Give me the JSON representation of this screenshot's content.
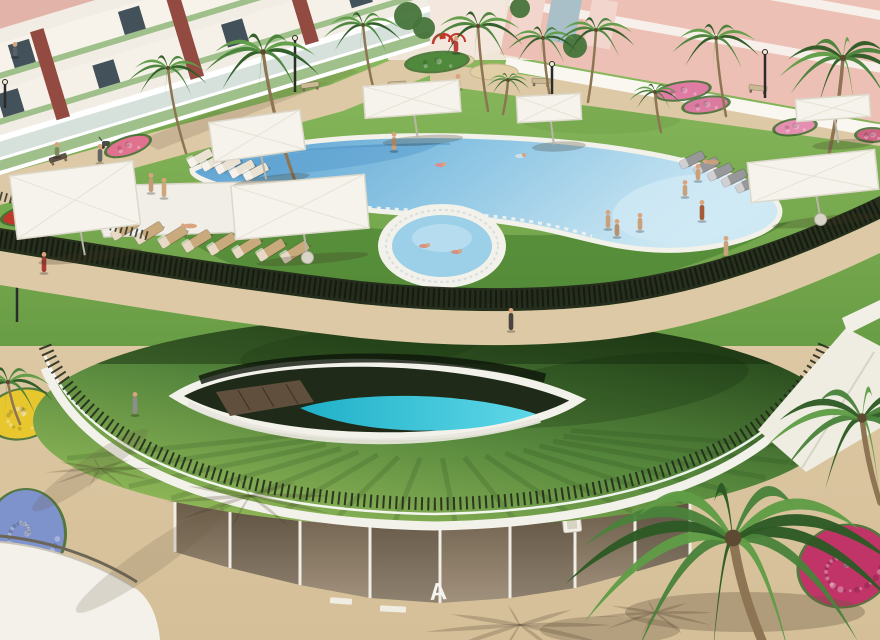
{
  "meta": {
    "title": "Aerial 3D render of residential resort pool courtyard",
    "type": "3d-architectural-render",
    "description": "Apartment complex garden with curved lagoon pool, circular kids pool, sun loungers, white parasols, palm trees and a grass-roofed clubhouse containing a lower-level lap pool"
  },
  "signage": {
    "block_letter": "A"
  },
  "palette": {
    "sand": "#ddc9a6",
    "sand_shadow": "#b59a74",
    "lawn_light": "#8cbb5e",
    "lawn_dark": "#699d45",
    "terrace_band": "#3f7a2c",
    "roof_dark": "#1f3d16",
    "roof_mid": "#55863c",
    "roof_light": "#9cc25e",
    "fence": "#22271b",
    "rim": "#f2f1ea",
    "pool_deep": "#5a9fd0",
    "pool_mid": "#8ec6e4",
    "pool_light": "#cfe9f4",
    "lap_pool": "#2ec4d9",
    "deck_wood": "#5f4f3c",
    "facade_dark": "#6f604c",
    "facade_light": "#a79782",
    "mullion": "#f0ede4",
    "building_white": "#f2ede4",
    "building_pink": "#ecc0b4",
    "building_pink_light": "#f2d5cc",
    "building_accent": "#934a40",
    "window": "#42515a",
    "trunk": "#8d7553",
    "palm_1": "#2d5a24",
    "palm_2": "#49823a",
    "palm_3": "#5f9c46",
    "umbrella": "#f5f3ec",
    "skin": "#d9a57e",
    "flame": "#ff8a28",
    "white_wall": "#f3f1ea"
  },
  "people_standing": [
    {
      "x": 100,
      "y": 162,
      "c": "#636660",
      "h": 13
    },
    {
      "x": 57,
      "y": 156,
      "c": "#7c8a5c",
      "h": 9
    },
    {
      "x": 151,
      "y": 192,
      "c": "#c59a76",
      "h": 14
    },
    {
      "x": 164,
      "y": 197,
      "c": "#cfa57e",
      "h": 14
    },
    {
      "x": 44,
      "y": 272,
      "c": "#a83a32",
      "h": 15
    },
    {
      "x": 135,
      "y": 414,
      "c": "#8d8d8b",
      "h": 17
    },
    {
      "x": 511,
      "y": 330,
      "c": "#4a4440",
      "h": 17
    },
    {
      "x": 456,
      "y": 52,
      "c": "#b84038",
      "h": 11
    },
    {
      "x": 458,
      "y": 88,
      "c": "#c59a76",
      "h": 9
    },
    {
      "x": 394,
      "y": 150,
      "c": "#c8a07c",
      "h": 13
    },
    {
      "x": 15,
      "y": 56,
      "c": "#5a5f66",
      "h": 9
    },
    {
      "x": 608,
      "y": 228,
      "c": "#c8a07c",
      "h": 13
    },
    {
      "x": 617,
      "y": 236,
      "c": "#b8906c",
      "h": 12
    },
    {
      "x": 640,
      "y": 230,
      "c": "#c8a07c",
      "h": 12
    },
    {
      "x": 698,
      "y": 180,
      "c": "#c8a07c",
      "h": 11
    },
    {
      "x": 685,
      "y": 196,
      "c": "#c8a07c",
      "h": 11
    },
    {
      "x": 702,
      "y": 220,
      "c": "#a55a38",
      "h": 15
    },
    {
      "x": 726,
      "y": 256,
      "c": "#c8a07c",
      "h": 15
    }
  ],
  "people_swimming": [
    {
      "x": 440,
      "y": 165,
      "c": "#e08a8a"
    },
    {
      "x": 338,
      "y": 181,
      "c": "#d9a57e"
    },
    {
      "x": 520,
      "y": 156,
      "c": "#cfe2ee"
    },
    {
      "x": 424,
      "y": 246,
      "c": "#d98c78"
    },
    {
      "x": 456,
      "y": 252,
      "c": "#d98c78"
    }
  ],
  "people_lying": [
    {
      "x": 712,
      "y": 162,
      "c": "#c8a07c"
    },
    {
      "x": 190,
      "y": 226,
      "c": "#d9a57e"
    }
  ],
  "palms_back": [
    {
      "x": 263,
      "y": 52,
      "r": 58,
      "dx": 40,
      "th": 150
    },
    {
      "x": 168,
      "y": 68,
      "r": 40,
      "dx": 18,
      "th": 85
    },
    {
      "x": 363,
      "y": 25,
      "r": 40,
      "dx": 12,
      "th": 70
    },
    {
      "x": 478,
      "y": 26,
      "r": 46,
      "dx": 10,
      "th": 85
    },
    {
      "x": 543,
      "y": 38,
      "r": 36,
      "dx": 8,
      "th": 66
    },
    {
      "x": 596,
      "y": 30,
      "r": 40,
      "dx": -8,
      "th": 72
    },
    {
      "x": 716,
      "y": 38,
      "r": 44,
      "dx": 10,
      "th": 78
    },
    {
      "x": 843,
      "y": 58,
      "r": 64,
      "dx": -16,
      "th": 105
    },
    {
      "x": 655,
      "y": 92,
      "r": 26,
      "dx": 6,
      "th": 40
    },
    {
      "x": 508,
      "y": 80,
      "r": 22,
      "dx": -5,
      "th": 34
    }
  ],
  "palms_front": [
    {
      "x": 8,
      "y": 382,
      "r": 46,
      "dx": 12,
      "th": 42
    },
    {
      "x": 862,
      "y": 418,
      "r": 96,
      "dx": 18,
      "th": 85
    },
    {
      "x": 733,
      "y": 538,
      "r": 168,
      "dx": 30,
      "th": 105
    }
  ],
  "shadow_fronds": [
    {
      "x": 250,
      "y": 495,
      "r": 85
    },
    {
      "x": 520,
      "y": 624,
      "r": 95
    },
    {
      "x": 655,
      "y": 612,
      "r": 60
    },
    {
      "x": 100,
      "y": 468,
      "r": 55
    }
  ],
  "umbrellas": [
    {
      "x": 257,
      "y": 136,
      "w": 92,
      "h": 40,
      "rot": -8,
      "base": false
    },
    {
      "x": 75,
      "y": 200,
      "w": 124,
      "h": 64,
      "rot": -7,
      "base": false
    },
    {
      "x": 300,
      "y": 207,
      "w": 134,
      "h": 54,
      "rot": -5,
      "base": true
    },
    {
      "x": 412,
      "y": 99,
      "w": 96,
      "h": 32,
      "rot": -4,
      "base": false
    },
    {
      "x": 549,
      "y": 108,
      "w": 64,
      "h": 26,
      "rot": -3,
      "base": false
    },
    {
      "x": 833,
      "y": 108,
      "w": 74,
      "h": 22,
      "rot": -4,
      "base": false
    },
    {
      "x": 813,
      "y": 176,
      "w": 128,
      "h": 40,
      "rot": -6,
      "base": true
    }
  ],
  "loungers": [
    {
      "x": 200,
      "y": 158,
      "rot": -28,
      "c": "#eae2d2",
      "w": 26,
      "h": 9
    },
    {
      "x": 214,
      "y": 162,
      "rot": -28,
      "c": "#eae2d2",
      "w": 26,
      "h": 9
    },
    {
      "x": 228,
      "y": 165,
      "rot": -28,
      "c": "#eae2d2",
      "w": 26,
      "h": 9
    },
    {
      "x": 242,
      "y": 169,
      "rot": -28,
      "c": "#eae2d2",
      "w": 26,
      "h": 9
    },
    {
      "x": 256,
      "y": 172,
      "rot": -28,
      "c": "#eae2d2",
      "w": 26,
      "h": 9
    },
    {
      "x": 125,
      "y": 229,
      "rot": -32,
      "c": "#c9aa7c",
      "w": 30,
      "h": 10
    },
    {
      "x": 149,
      "y": 233,
      "rot": -32,
      "c": "#c9aa7c",
      "w": 30,
      "h": 10
    },
    {
      "x": 173,
      "y": 237,
      "rot": -32,
      "c": "#c9aa7c",
      "w": 30,
      "h": 10
    },
    {
      "x": 197,
      "y": 241,
      "rot": -32,
      "c": "#c9aa7c",
      "w": 30,
      "h": 10
    },
    {
      "x": 222,
      "y": 244,
      "rot": -32,
      "c": "#c9aa7c",
      "w": 30,
      "h": 10
    },
    {
      "x": 247,
      "y": 247,
      "rot": -32,
      "c": "#c9aa7c",
      "w": 30,
      "h": 10
    },
    {
      "x": 271,
      "y": 250,
      "rot": -32,
      "c": "#c9aa7c",
      "w": 30,
      "h": 10
    },
    {
      "x": 295,
      "y": 252,
      "rot": -32,
      "c": "#c9aa7c",
      "w": 30,
      "h": 10
    },
    {
      "x": 692,
      "y": 160,
      "rot": -26,
      "c": "#98989a",
      "w": 26,
      "h": 9
    },
    {
      "x": 706,
      "y": 166,
      "rot": -26,
      "c": "#98989a",
      "w": 26,
      "h": 9
    },
    {
      "x": 720,
      "y": 172,
      "rot": -26,
      "c": "#98989a",
      "w": 26,
      "h": 9
    },
    {
      "x": 734,
      "y": 178,
      "rot": -26,
      "c": "#98989a",
      "w": 26,
      "h": 9
    },
    {
      "x": 748,
      "y": 184,
      "rot": -26,
      "c": "#98989a",
      "w": 26,
      "h": 9
    }
  ],
  "flower_beds": [
    {
      "x": 58,
      "y": 210,
      "rx": 56,
      "ry": 12,
      "c": "#bb3a2c",
      "rot": -10
    },
    {
      "x": 128,
      "y": 146,
      "rx": 22,
      "ry": 8,
      "c": "#e0718f",
      "rot": -18
    },
    {
      "x": 683,
      "y": 91,
      "rx": 26,
      "ry": 8,
      "c": "#e07ba3",
      "rot": -8
    },
    {
      "x": 706,
      "y": 105,
      "rx": 22,
      "ry": 7,
      "c": "#db7ba0",
      "rot": -8
    },
    {
      "x": 795,
      "y": 127,
      "rx": 20,
      "ry": 7,
      "c": "#e58fb0",
      "rot": -8
    },
    {
      "x": 872,
      "y": 135,
      "rx": 15,
      "ry": 6,
      "c": "#cf6585",
      "rot": 0
    },
    {
      "x": 22,
      "y": 414,
      "rx": 34,
      "ry": 24,
      "c": "#e7c62e",
      "rot": -12
    },
    {
      "x": 26,
      "y": 534,
      "rx": 38,
      "ry": 44,
      "c": "#7e92cc",
      "rot": 0
    },
    {
      "x": 845,
      "y": 566,
      "rx": 46,
      "ry": 40,
      "c": "#c13468",
      "rot": -15
    },
    {
      "x": 437,
      "y": 62,
      "rx": 30,
      "ry": 9,
      "c": "#4f8a3c",
      "rot": -5
    }
  ],
  "benches": [
    {
      "x": 58,
      "y": 158,
      "rot": -18,
      "c": "#5f5246"
    },
    {
      "x": 310,
      "y": 85,
      "rot": -8,
      "c": "#cbb894"
    },
    {
      "x": 397,
      "y": 84,
      "rot": -4,
      "c": "#cbb894"
    },
    {
      "x": 541,
      "y": 81,
      "rot": 3,
      "c": "#cbb894"
    },
    {
      "x": 758,
      "y": 88,
      "rot": 7,
      "c": "#cbb894"
    }
  ],
  "lamps": [
    {
      "x": 17,
      "y": 322,
      "h": 56,
      "arm": true
    },
    {
      "x": 295,
      "y": 92,
      "h": 54,
      "arm": false
    },
    {
      "x": 765,
      "y": 98,
      "h": 46,
      "arm": false
    },
    {
      "x": 5,
      "y": 108,
      "h": 26,
      "arm": false
    },
    {
      "x": 552,
      "y": 112,
      "h": 48,
      "arm": false
    }
  ],
  "sand_patches": [
    {
      "x": 452,
      "y": 60,
      "rx": 22,
      "ry": 7
    },
    {
      "x": 494,
      "y": 72,
      "rx": 24,
      "ry": 8
    }
  ],
  "background_trees": [
    {
      "x": 408,
      "y": 16,
      "r": 14
    },
    {
      "x": 424,
      "y": 28,
      "r": 11
    },
    {
      "x": 520,
      "y": 8,
      "r": 10
    },
    {
      "x": 575,
      "y": 46,
      "r": 12
    }
  ]
}
